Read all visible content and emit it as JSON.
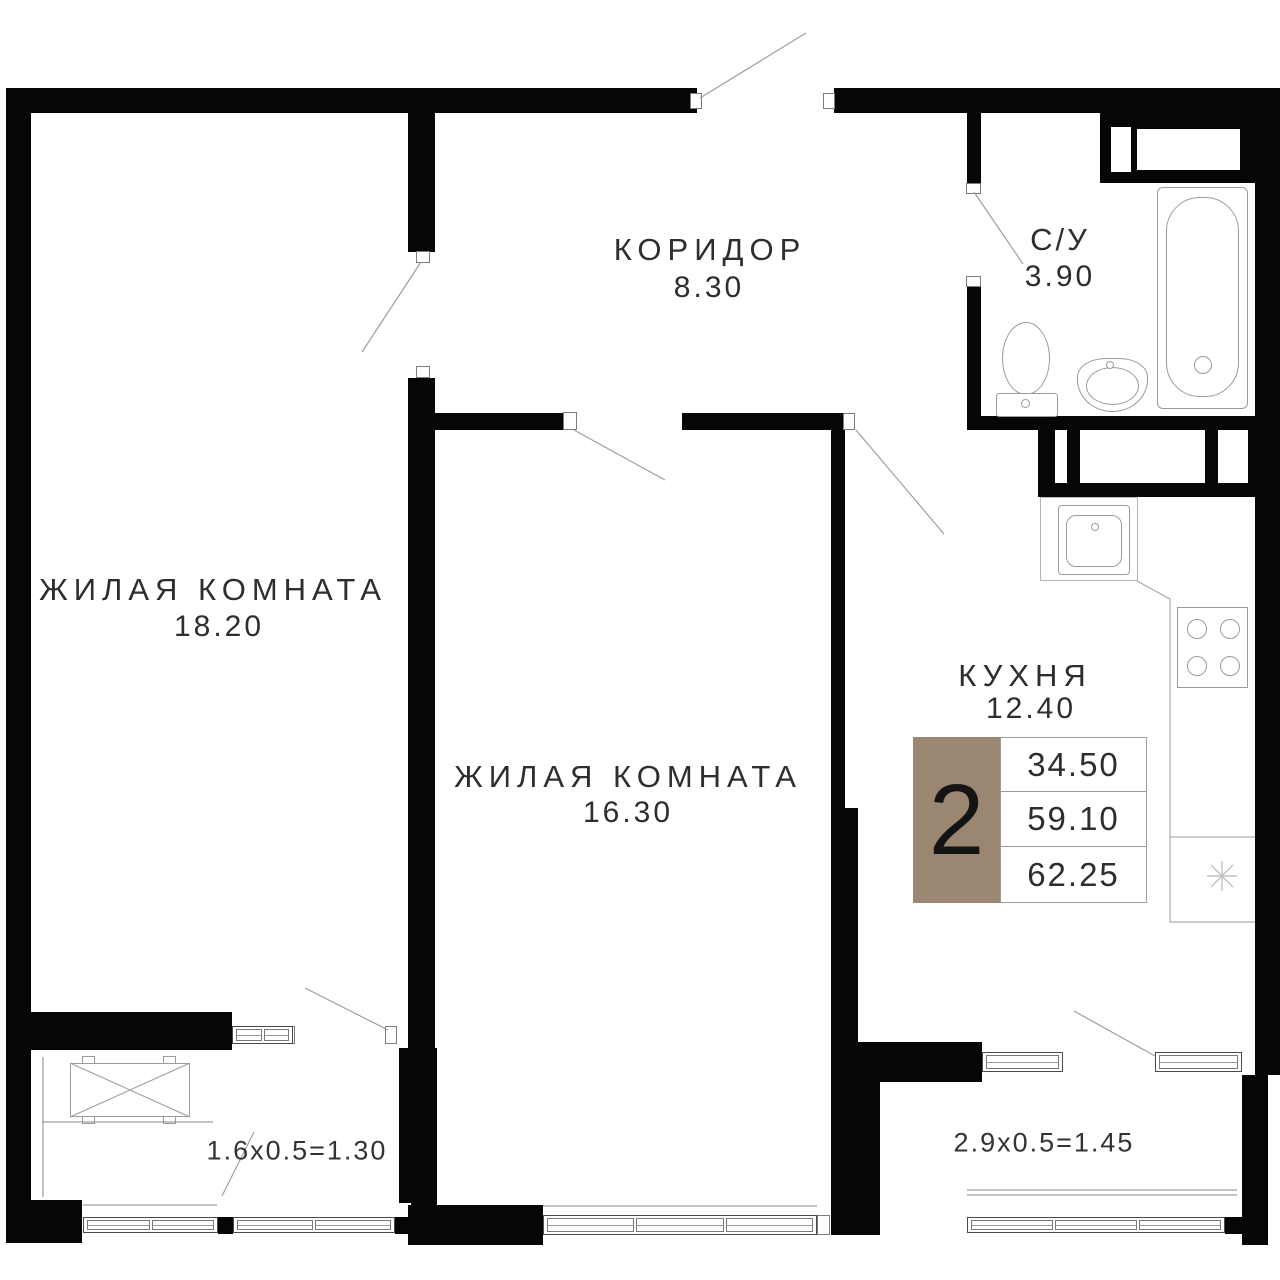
{
  "plan": {
    "rooms": [
      {
        "name": "ЖИЛАЯ КОМНАТА",
        "area": "18.20"
      },
      {
        "name": "ЖИЛАЯ КОМНАТА",
        "area": "16.30"
      },
      {
        "name": "КОРИДОР",
        "area": "8.30"
      },
      {
        "name": "С/У",
        "area": "3.90"
      },
      {
        "name": "КУХНЯ",
        "area": "12.40"
      }
    ],
    "balconies": [
      {
        "dimension": "1.6x0.5=1.30"
      },
      {
        "dimension": "2.9x0.5=1.45"
      }
    ],
    "badge": {
      "rooms_count": "2",
      "areas": [
        "34.50",
        "59.10",
        "62.25"
      ],
      "accent_color": "#9a8671"
    }
  }
}
